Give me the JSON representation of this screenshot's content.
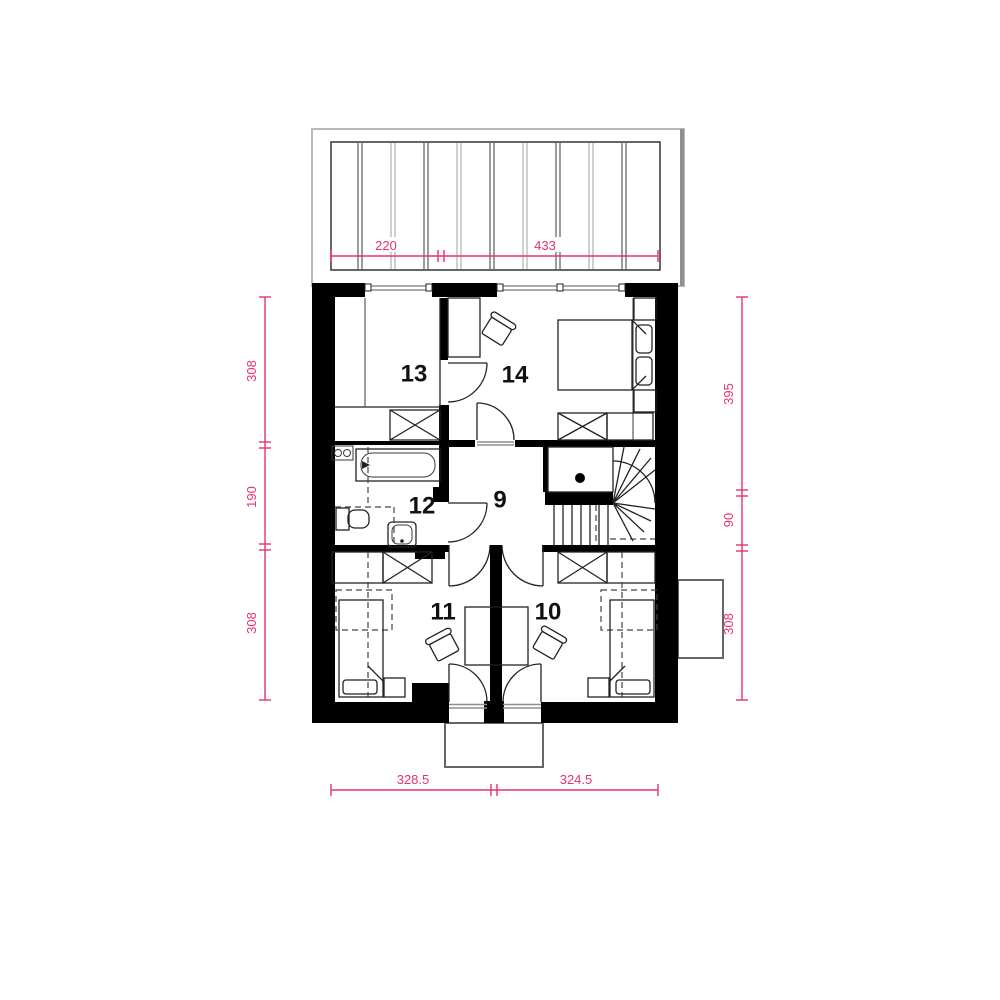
{
  "page": {
    "background": "#ffffff"
  },
  "colors": {
    "wall": "#000000",
    "line": "#222222",
    "gray": "#8f8f8f",
    "dimension": "#e8316f",
    "label": "#111111"
  },
  "rooms": {
    "r9": {
      "label": "9"
    },
    "r10": {
      "label": "10"
    },
    "r11": {
      "label": "11"
    },
    "r12": {
      "label": "12"
    },
    "r13": {
      "label": "13"
    },
    "r14": {
      "label": "14"
    }
  },
  "dimensions": {
    "top": {
      "d1": "220",
      "d2": "433"
    },
    "bottom": {
      "d1": "328.5",
      "d2": "324.5"
    },
    "left": {
      "d1": "308",
      "d2": "190",
      "d3": "308"
    },
    "right": {
      "d1": "395",
      "d2": "90",
      "d3": "308"
    }
  }
}
